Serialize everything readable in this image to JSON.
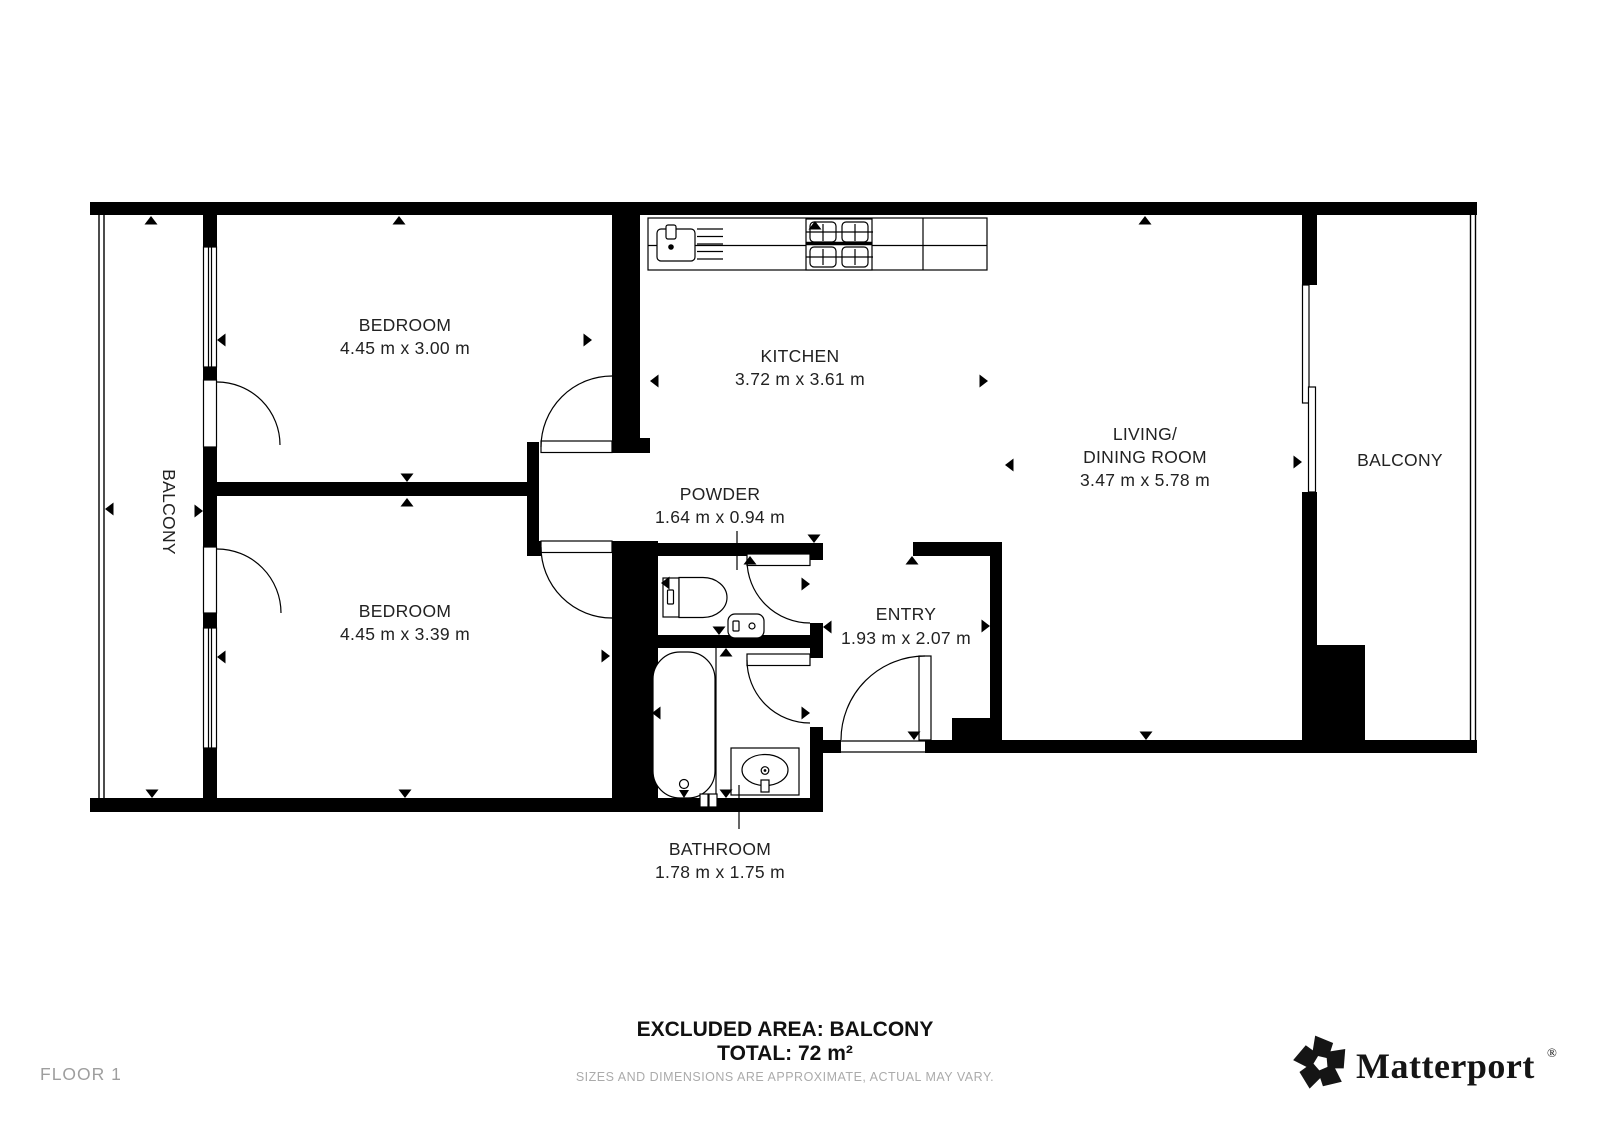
{
  "colors": {
    "wall": "#000000",
    "label_text": "#222222",
    "muted_text": "#9e9e9e",
    "disclaimer_text": "#ababab",
    "brand_text": "#151515",
    "background": "#ffffff"
  },
  "rooms": {
    "bedroom_1": {
      "name": "BEDROOM",
      "dimensions": "4.45 m x 3.00 m"
    },
    "bedroom_2": {
      "name": "BEDROOM",
      "dimensions": "4.45 m x 3.39 m"
    },
    "kitchen": {
      "name": "KITCHEN",
      "dimensions": "3.72 m x 3.61 m"
    },
    "living_dining": {
      "name_line1": "LIVING/",
      "name_line2": "DINING ROOM",
      "dimensions": "3.47 m x 5.78 m"
    },
    "powder": {
      "name": "POWDER",
      "dimensions": "1.64 m x 0.94 m"
    },
    "entry": {
      "name": "ENTRY",
      "dimensions": "1.93 m x 2.07 m"
    },
    "bathroom": {
      "name": "BATHROOM",
      "dimensions": "1.78 m x 1.75 m"
    },
    "balcony_left": {
      "name": "BALCONY"
    },
    "balcony_right": {
      "name": "BALCONY"
    }
  },
  "footer": {
    "excluded_area": "EXCLUDED AREA: BALCONY",
    "total": "TOTAL: 72 m²",
    "disclaimer": "SIZES AND DIMENSIONS ARE APPROXIMATE, ACTUAL MAY VARY.",
    "floor_label": "FLOOR 1",
    "brand": "Matterport",
    "registered_mark": "®"
  },
  "icons": {
    "kitchen_sink": "rounded-square-with-faucet",
    "dish_rack": "horizontal-lines",
    "stove": "four-burner-grid",
    "toilet": "cistern-and-bowl",
    "powder_sink": "small-rounded-basin",
    "bathtub": "stadium-shape-with-faucet",
    "bathroom_sink": "vanity-oval-basin",
    "dimension_arrow": "small-black-triangle",
    "matterport_mark": "five-blade-pinwheel"
  }
}
